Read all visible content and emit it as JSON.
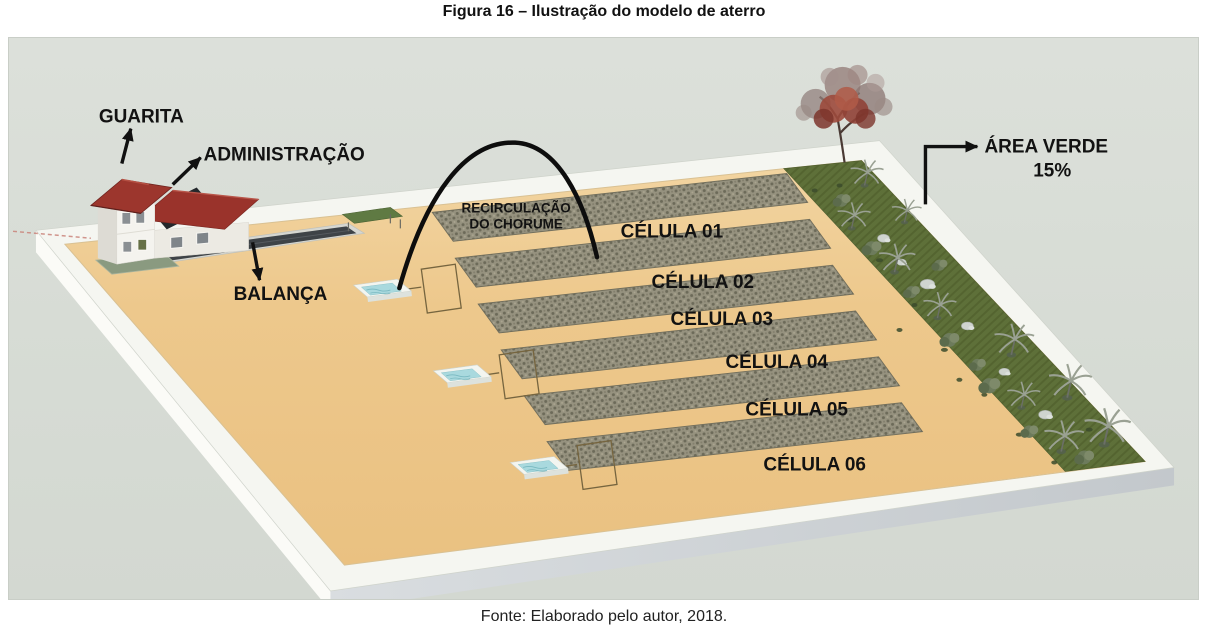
{
  "figure": {
    "title": "Figura 16 – Ilustração do modelo de aterro",
    "caption": "Fonte: Elaborado pelo autor, 2018.",
    "labels": {
      "guarita": "GUARITA",
      "administracao": "ADMINISTRAÇÃO",
      "balanca": "BALANÇA",
      "recirculacao_line1": "RECIRCULAÇÃO",
      "recirculacao_line2": "DO CHORUME",
      "area_verde": "ÁREA VERDE",
      "area_verde_percent": "15%"
    },
    "cells": [
      "CÉLULA 01",
      "CÉLULA 02",
      "CÉLULA 03",
      "CÉLULA 04",
      "CÉLULA 05",
      "CÉLULA 06"
    ],
    "colors": {
      "background": "#d8ddd6",
      "sand": "#edc88c",
      "green_area": "#5e7039",
      "cell_fill": "#96927f",
      "water": "#a9d9de",
      "roof_red": "#9c352c",
      "annotation": "#111111"
    }
  }
}
